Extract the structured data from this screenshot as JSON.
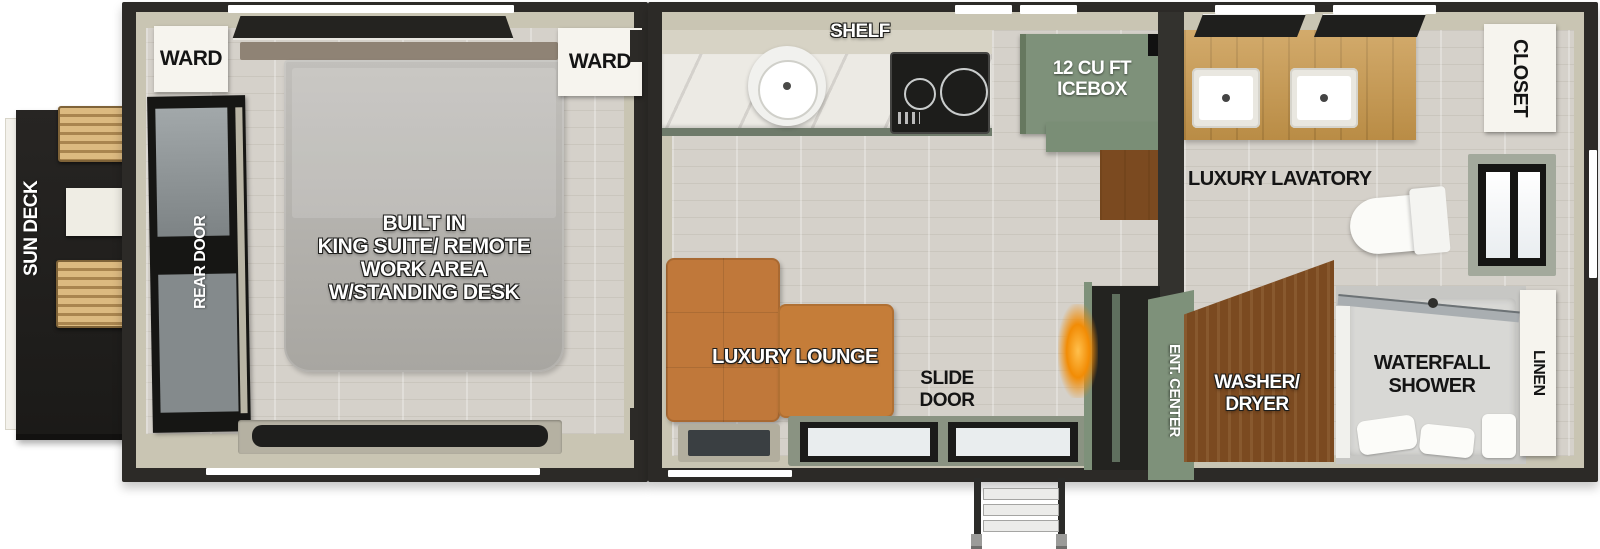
{
  "floorplan": {
    "type": "travel-trailer-floor-plan",
    "labels": {
      "sun_deck": "SUN DECK",
      "ward_left": "WARD",
      "ward_right": "WARD",
      "rear_door": "REAR DOOR",
      "king_suite": "BUILT IN\nKING SUITE/ REMOTE\nWORK AREA\nW/STANDING DESK",
      "shelf": "SHELF",
      "icebox": "12 CU FT\nICEBOX",
      "luxury_lavatory": "LUXURY LAVATORY",
      "closet": "CLOSET",
      "luxury_lounge": "LUXURY LOUNGE",
      "slide_door": "SLIDE\nDOOR",
      "ent_center": "ENT. CENTER",
      "washer_dryer": "WASHER/\nDRYER",
      "waterfall_shower": "WATERFALL\nSHOWER",
      "linen": "LINEN"
    },
    "icons": {
      "kitchen_sink": "css-circle-basin",
      "cooktop": "css-two-burner-rings",
      "refrigerator": "green-icebox-block",
      "toilet": "css-bowl-and-tank",
      "vanity_sinks": "css-double-rect-basins",
      "fireplace": "orange-radial-glow",
      "entry_steps": "css-ladder-steps",
      "lounge_chairs": "wood-slat-chaises",
      "king_bed": "gray-rounded-mattress",
      "slide_door_glass": "dark-frame-glass-panels",
      "shower_glass": "diagonal-glass-door"
    },
    "colors": {
      "wall_dark": "#2c2a27",
      "wall_beige": "#c9c5b3",
      "floor": "#d5d1ca",
      "sage": "#7e917a",
      "sage_dark": "#6e7a6a",
      "sofa": "#c0783a",
      "vanity_wood": "#c9984b",
      "cabinet_brown": "#7b4a20",
      "deck_black": "#201f1d",
      "fire_glow": "#f28c05"
    }
  }
}
